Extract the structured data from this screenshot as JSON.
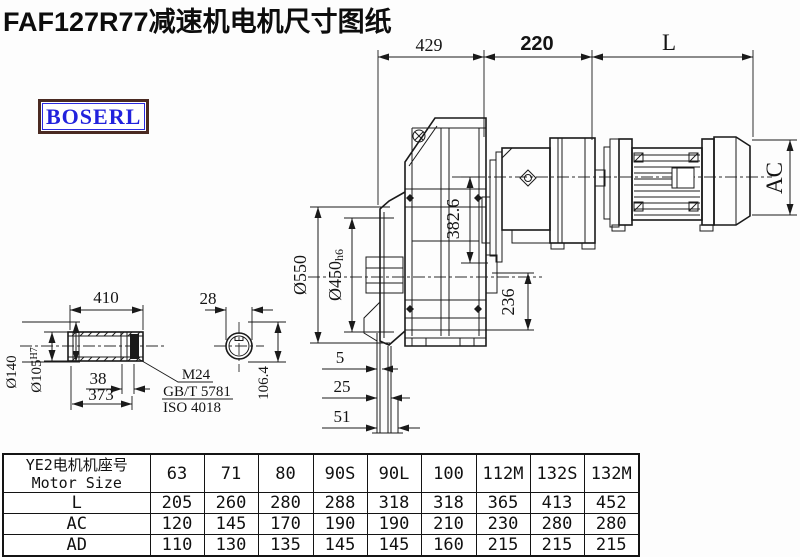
{
  "title": "FAF127R77减速机电机尺寸图纸",
  "logo": {
    "text": "BOSERL"
  },
  "colors": {
    "line": "#1a1a1a",
    "logo_text": "#2222dd",
    "logo_border": "#4a2a22",
    "title": "#0d0d0d"
  },
  "drawing": {
    "dims": {
      "top_429": "429",
      "top_220": "220",
      "top_L": "L",
      "ac": "AC",
      "dia550": "Ø550",
      "dia450": "Ø450",
      "dia450_suffix": "h6",
      "v382": "382.6",
      "v236": "236",
      "h5": "5",
      "h25": "25",
      "h51": "51",
      "shaft_410": "410",
      "shaft_38": "38",
      "shaft_373": "373",
      "dia140": "Ø140",
      "dia105": "Ø105",
      "dia105_suffix": "H7",
      "key_28": "28",
      "key_106": "106.4",
      "note_m24": "M24",
      "note_gbt": "GB/T 5781",
      "note_iso": "ISO 4018"
    }
  },
  "table": {
    "header_cn": "YE2电机机座号",
    "header_en": "Motor Size",
    "sizes": [
      "63",
      "71",
      "80",
      "90S",
      "90L",
      "100",
      "112M",
      "132S",
      "132M"
    ],
    "rows": [
      {
        "label": "L",
        "values": [
          "205",
          "260",
          "280",
          "288",
          "318",
          "318",
          "365",
          "413",
          "452"
        ]
      },
      {
        "label": "AC",
        "values": [
          "120",
          "145",
          "170",
          "190",
          "190",
          "210",
          "230",
          "280",
          "280"
        ]
      },
      {
        "label": "AD",
        "values": [
          "110",
          "130",
          "135",
          "145",
          "145",
          "160",
          "215",
          "215",
          "215"
        ]
      }
    ]
  }
}
